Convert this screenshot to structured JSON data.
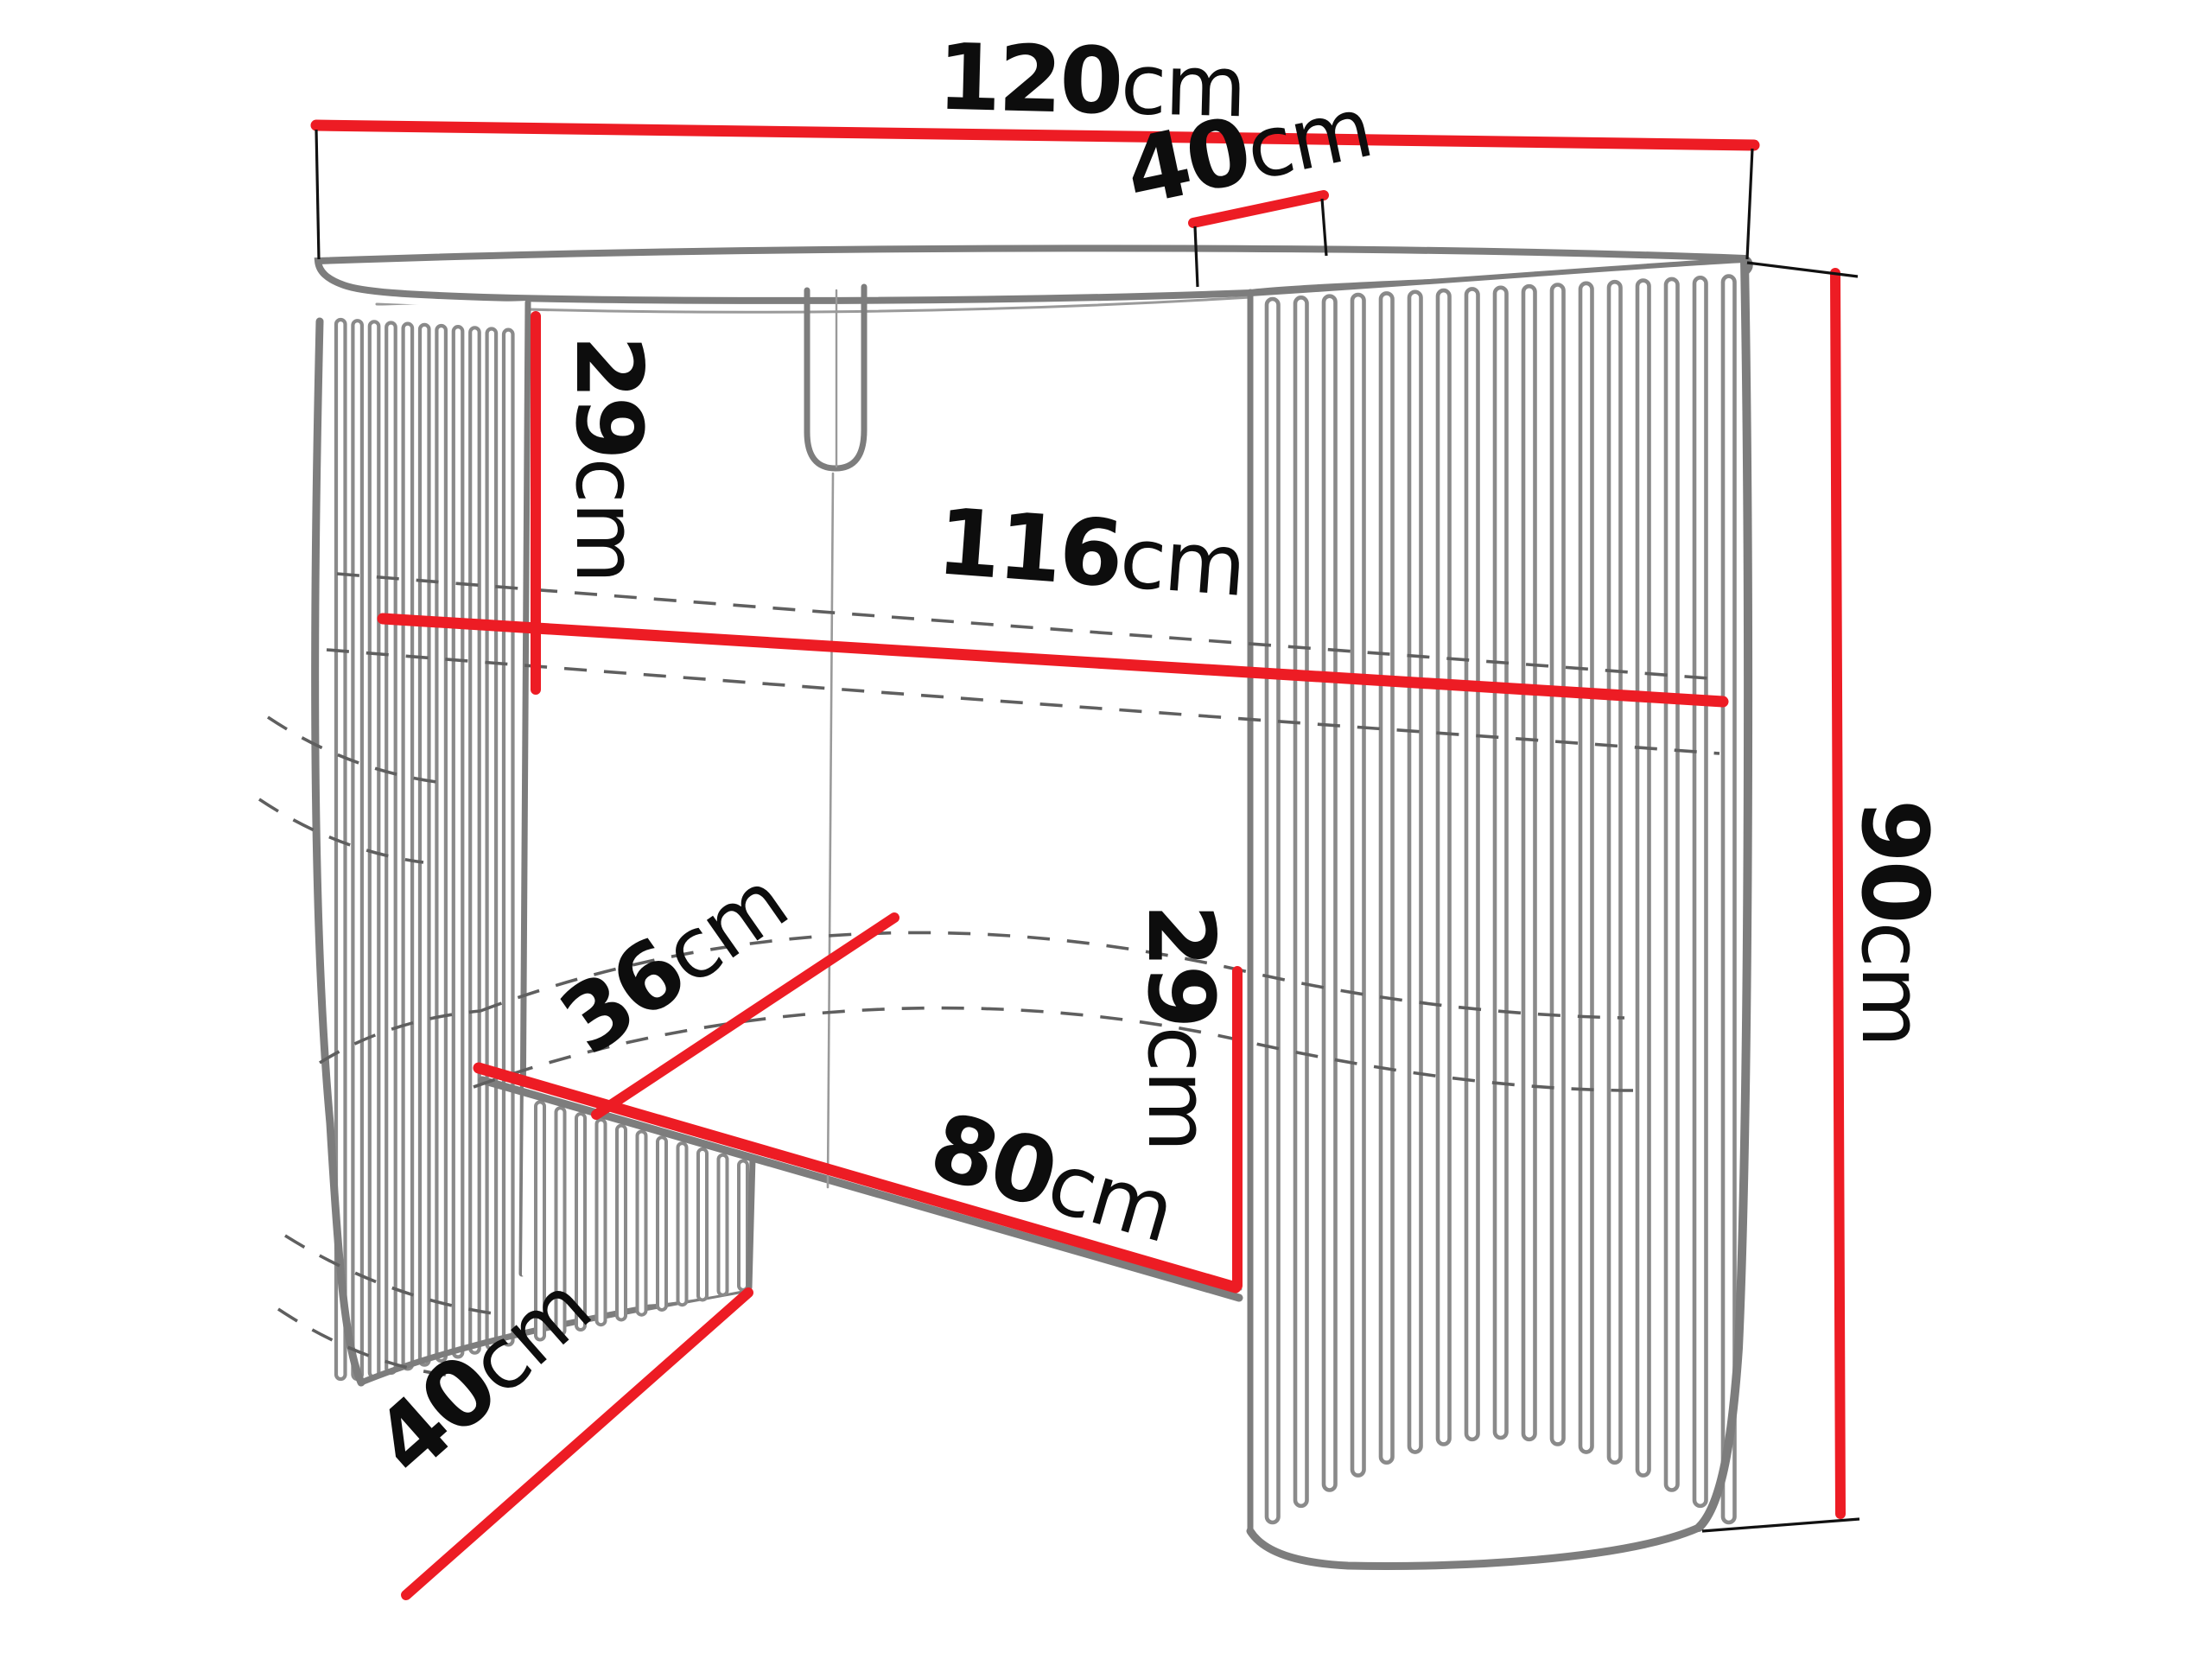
{
  "diagram": {
    "type": "furniture-dimension-drawing",
    "colors": {
      "dimension_line_red": "#ed1c24",
      "furniture_outline_gray": "#7d7d7d",
      "hidden_edge_dash_gray": "#5f5f5f",
      "label_text": "#0d0d0d",
      "background": "#ffffff"
    },
    "measurements": {
      "width_top": {
        "value": "120",
        "unit": "cm"
      },
      "depth_top": {
        "value": "40",
        "unit": "cm"
      },
      "height_upper": {
        "value": "29",
        "unit": "cm"
      },
      "width_inner": {
        "value": "116",
        "unit": "cm"
      },
      "height_total": {
        "value": "90",
        "unit": "cm"
      },
      "depth_lower": {
        "value": "36",
        "unit": "cm"
      },
      "width_bottom": {
        "value": "80",
        "unit": "cm"
      },
      "height_lower": {
        "value": "29",
        "unit": "cm"
      },
      "depth_base": {
        "value": "40",
        "unit": "cm"
      }
    }
  }
}
